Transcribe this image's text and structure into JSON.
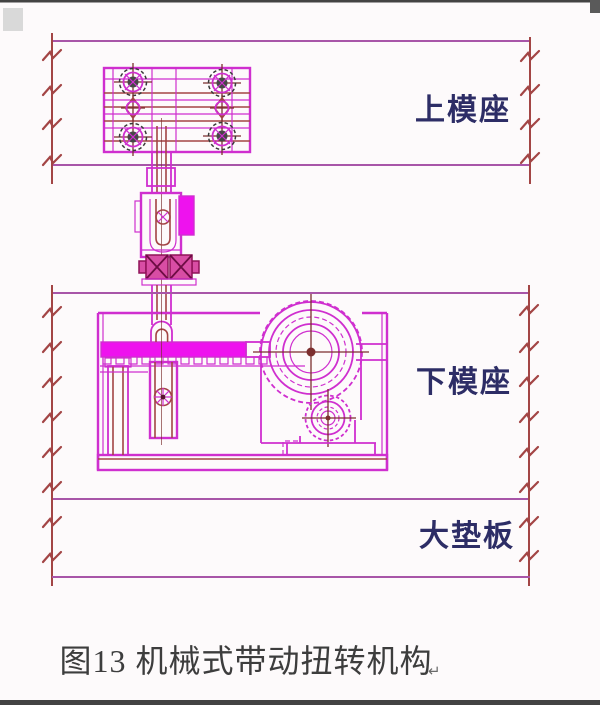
{
  "window": {
    "width": 600,
    "height": 705
  },
  "figure": {
    "caption": "图13 机械式带动扭转机构",
    "return_mark": "↵",
    "labels": {
      "upper_die": "上模座",
      "lower_die": "下模座",
      "backing_plate": "大垫板"
    }
  },
  "colors": {
    "background": "#fdfafb",
    "magenta": "#cf2fcf",
    "magenta_bright": "#ee12ee",
    "purple_band": "#a855a8",
    "dark_red": "#a34545",
    "crosshair": "#7c2f2f",
    "bolt_dark": "#3a3a3a",
    "nut_fill": "#d84da4",
    "nut_stroke": "#8f1258",
    "nut_cross": "#6e0c44",
    "label_blue": "#2d2d66",
    "caption_gray": "#3d3d3d",
    "edge_dark": "#434343"
  }
}
